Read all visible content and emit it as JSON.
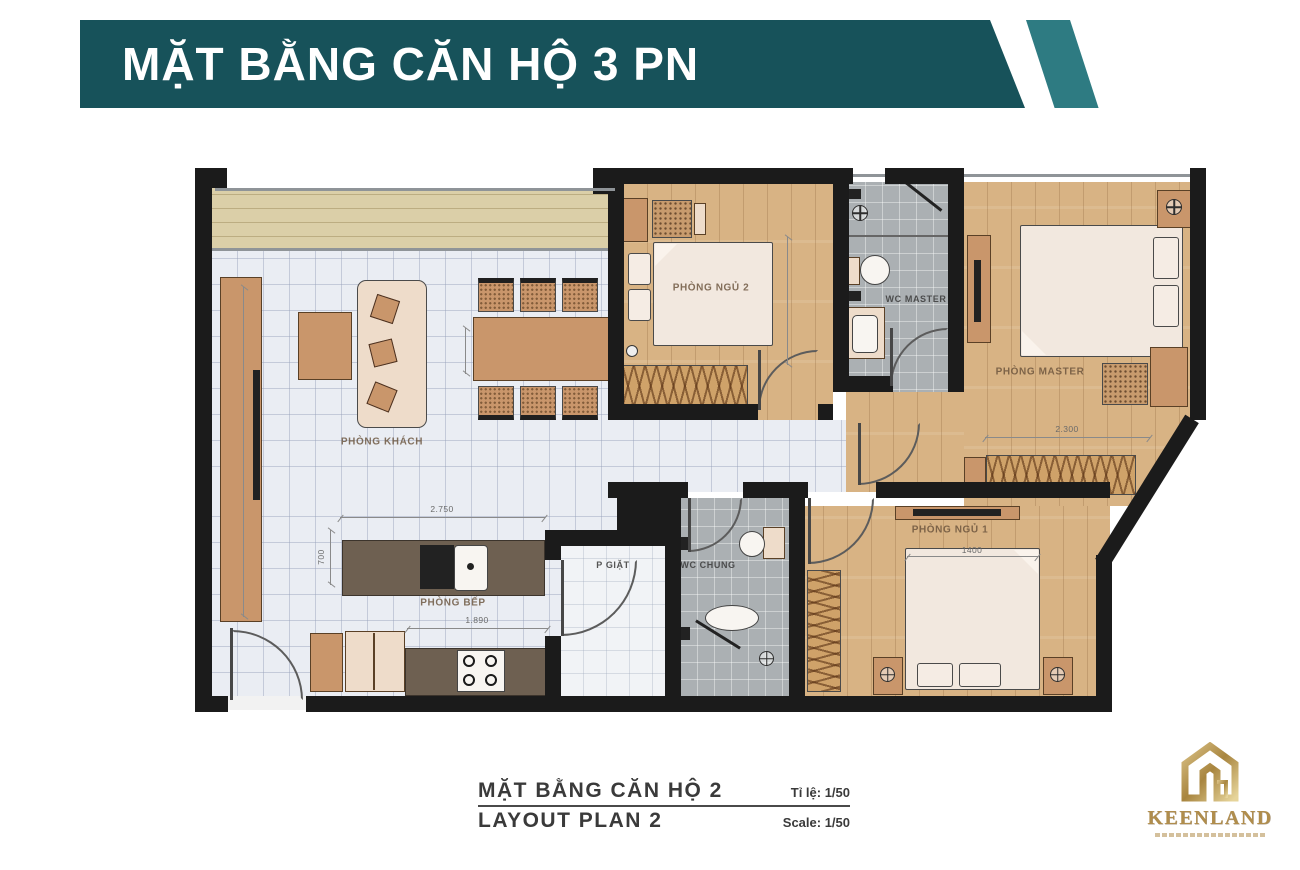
{
  "header": {
    "title": "MẶT BẰNG CĂN HỘ 3 PN"
  },
  "plan": {
    "rooms": [
      {
        "key": "living",
        "label": "PHÒNG KHÁCH"
      },
      {
        "key": "kitchen",
        "label": "PHÒNG BẾP"
      },
      {
        "key": "laundry",
        "label": "P GIẶT"
      },
      {
        "key": "wc_shared",
        "label": "WC CHUNG"
      },
      {
        "key": "bedroom2",
        "label": "PHÒNG NGỦ 2"
      },
      {
        "key": "wc_master",
        "label": "WC MASTER"
      },
      {
        "key": "master_bedroom",
        "label": "PHÒNG MASTER"
      },
      {
        "key": "bedroom1",
        "label": "PHÒNG NGỦ 1"
      }
    ],
    "dimensions": {
      "kitchen_island_length": "2.750",
      "kitchen_island_depth": "700",
      "kitchen_counter_run": "1.890",
      "master_wardrobe_width": "2.300",
      "bedroom1_bed_width": "1400"
    },
    "colors": {
      "wall": "#1b1b1b",
      "wood_floor": "#d8b384",
      "tile_floor": "#eaedf3",
      "bath_floor": "#abb0b3",
      "balcony_floor": "#dbcfa8",
      "counter": "#6e6051",
      "furniture": "#c9966b",
      "banner": "#17525a",
      "banner_stripe": "#2e7b82",
      "logo_gold": "#b08d4c"
    }
  },
  "caption": {
    "title_vi": "MẶT BẰNG CĂN HỘ 2",
    "title_en": "LAYOUT PLAN 2",
    "scale_vi": "Tỉ lệ: 1/50",
    "scale_en": "Scale: 1/50"
  },
  "logo": {
    "brand": "KEENLAND"
  }
}
